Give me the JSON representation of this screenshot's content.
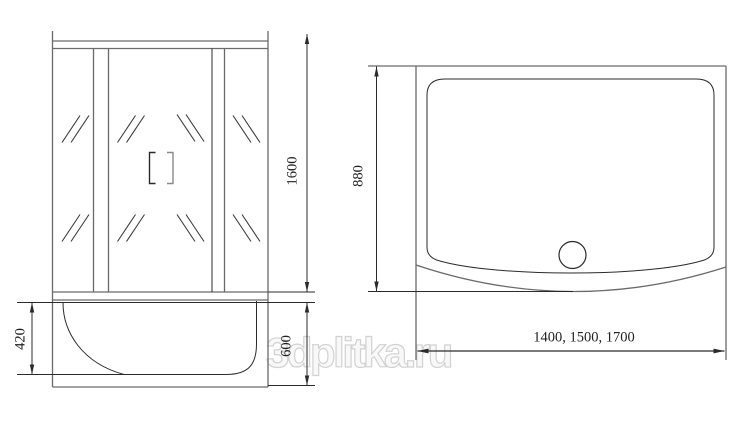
{
  "watermark": {
    "text": "3dplitka.ru",
    "outline_color": "#d2d2d2"
  },
  "front_view": {
    "dim_glass_height": "1600",
    "dim_tray_inner_height": "420",
    "dim_tray_height": "600"
  },
  "top_view": {
    "dim_depth": "880",
    "dim_widths": "1400, 1500, 1700"
  },
  "colors": {
    "background": "#ffffff",
    "structure_line": "#6a6a6a",
    "detail_line": "#2b2b2b",
    "label_text": "#1f1f1f"
  }
}
